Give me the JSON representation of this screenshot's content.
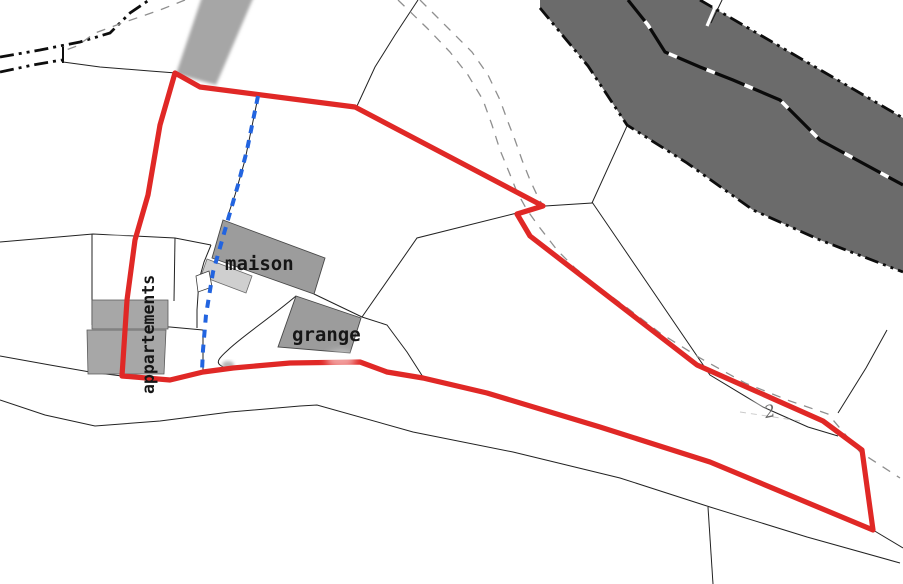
{
  "map": {
    "title": "cadastral-plan",
    "labels": {
      "maison": "maison",
      "grange": "grange",
      "appartements": "appartements",
      "parcel_number": "2"
    },
    "features": {
      "red_outline": "surveyed parcel highlight",
      "blue_dashed": "utility / pipe line",
      "dark_band": "main road",
      "light_band": "secondary road"
    },
    "colors": {
      "highlight_red": "#e02826",
      "utility_blue": "#2264e0",
      "road_dark": "#6b6b6b",
      "road_light": "#a6a6a6",
      "building_gray": "#9c9c9c",
      "building_light": "#cfcfcf",
      "block_gray": "#a7a7a7",
      "line_dark": "#222222",
      "path_gray": "#8f8f8f",
      "boundary_black": "#0d0d0d",
      "label_black": "#161616",
      "label_gray": "#666666"
    }
  }
}
